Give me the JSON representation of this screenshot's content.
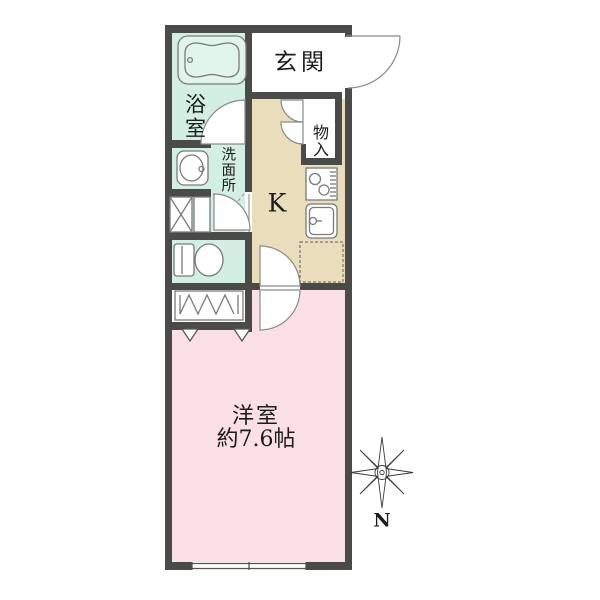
{
  "plan": {
    "labels": {
      "entrance": "玄関",
      "bathroom": "浴室",
      "washroom": "洗面所",
      "storage": "物入",
      "kitchen": "K",
      "living_room": "洋室",
      "living_room_size": "約7.6帖",
      "compass_north": "N"
    },
    "colors": {
      "wall": "#4a4a48",
      "wet_area_floor": "#d3efe3",
      "kitchen_floor": "#e9ddbb",
      "room_floor": "#fbdfe6",
      "fixture_line": "#7a7a78",
      "tub_fill": "#e2f5ec"
    }
  }
}
